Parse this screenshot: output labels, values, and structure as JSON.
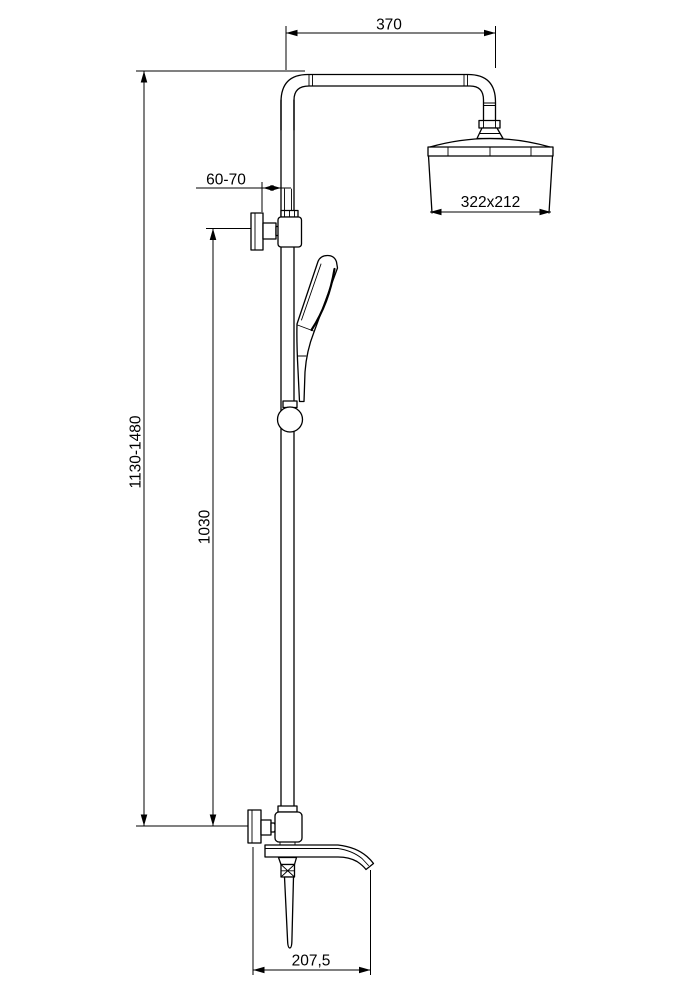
{
  "colors": {
    "background": "#ffffff",
    "line": "#000000"
  },
  "drawing": {
    "kind": "shower-column-dimension-drawing",
    "dimensions": {
      "arm_reach": "370",
      "wall_distance": "60-70",
      "head_size": "322x212",
      "total_height": "1130-1480",
      "bar_height": "1030",
      "spout_reach": "207,5"
    }
  }
}
